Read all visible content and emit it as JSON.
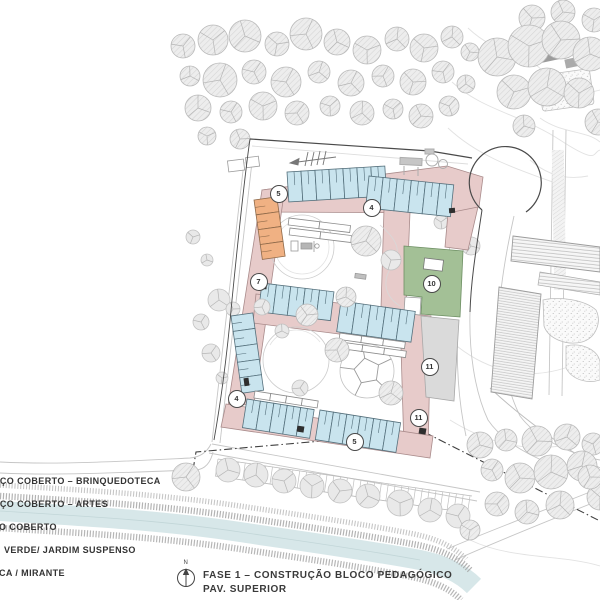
{
  "drawing": {
    "title_line1": "FASE 1 – CONSTRUÇÃO BLOCO PEDAGÓGICO",
    "title_line2": "PAV. SUPERIOR",
    "north_label": "N"
  },
  "legend": {
    "items": [
      {
        "label": "AÇO COBERTO – BRINQUEDOTECA"
      },
      {
        "label": "AÇO COBERTO – ARTES"
      },
      {
        "label": "O COBERTO"
      },
      {
        "label": "VERDE/ JARDIM SUSPENSO"
      },
      {
        "label": "CA / MIRANTE"
      }
    ]
  },
  "markers": [
    {
      "label": "5"
    },
    {
      "label": "4"
    },
    {
      "label": "7"
    },
    {
      "label": "10"
    },
    {
      "label": "11"
    },
    {
      "label": "4"
    },
    {
      "label": "11"
    },
    {
      "label": "5"
    }
  ],
  "colors": {
    "classroom_blue": "#c9e4ee",
    "circulation_pink": "#e7cbca",
    "block_orange": "#f0b183",
    "green_roof": "#a3c096",
    "terrace_gray": "#dadada",
    "water": "#d7e7e9"
  },
  "icons": {
    "north_arrow": "north-arrow-icon",
    "survey_arrow": "survey-arrow-icon",
    "playground_pentagon": "pentagon-climber-icon",
    "play_equipment": "play-equipment-icon"
  }
}
